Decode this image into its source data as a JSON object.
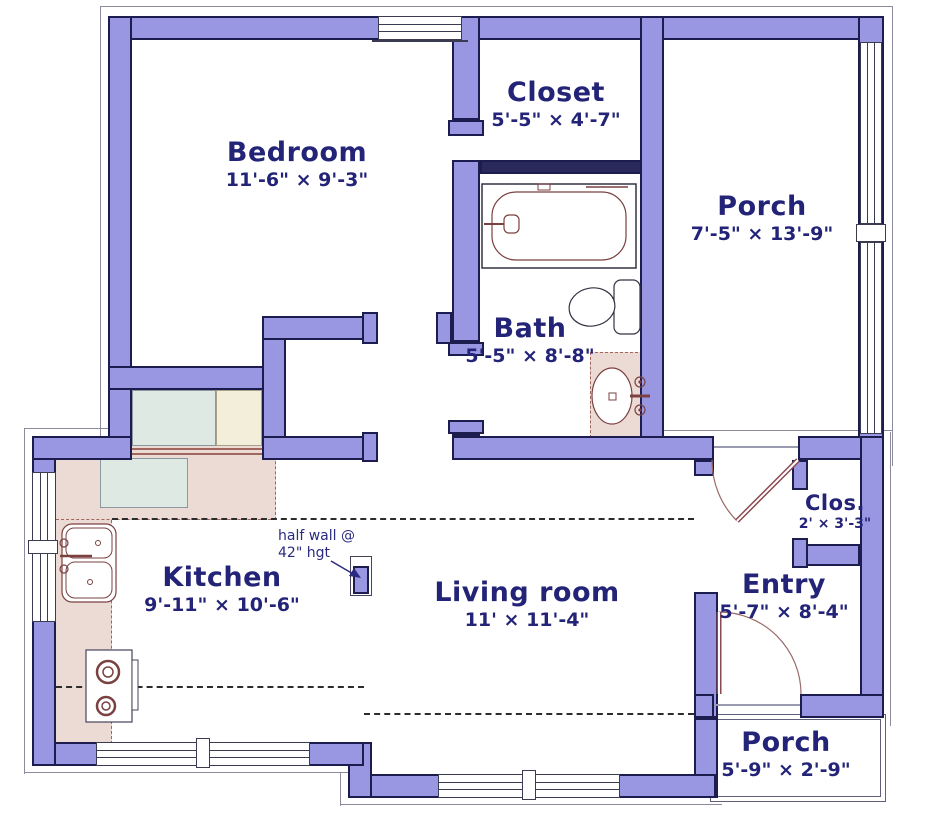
{
  "rooms": {
    "bedroom": {
      "name": "Bedroom",
      "dims": "11'-6\" × 9'-3\""
    },
    "closet": {
      "name": "Closet",
      "dims": "5'-5\" × 4'-7\""
    },
    "porch_upper": {
      "name": "Porch",
      "dims": "7'-5\" × 13'-9\""
    },
    "bath": {
      "name": "Bath",
      "dims": "5'-5\" × 8'-8\""
    },
    "kitchen": {
      "name": "Kitchen",
      "dims": "9'-11\" × 10'-6\""
    },
    "living_room": {
      "name": "Living room",
      "dims": "11' × 11'-4\""
    },
    "entry": {
      "name": "Entry",
      "dims": "5'-7\" × 8'-4\""
    },
    "closet_small": {
      "name": "Clos.",
      "dims": "2' × 3'-3\""
    },
    "porch_lower": {
      "name": "Porch",
      "dims": "5'-9\" × 2'-9\""
    }
  },
  "annotations": {
    "half_wall_line1": "half wall @",
    "half_wall_line2": "42\" hgt"
  },
  "colors": {
    "wall_fill": "#9a97e2",
    "wall_outline": "#1c1c4e",
    "label_text": "#232377",
    "fixture_line": "#7b4040",
    "counter_fill": "#ecdbd5",
    "appliance_blue": "#dfe9e4",
    "appliance_cream": "#f3eed9"
  }
}
